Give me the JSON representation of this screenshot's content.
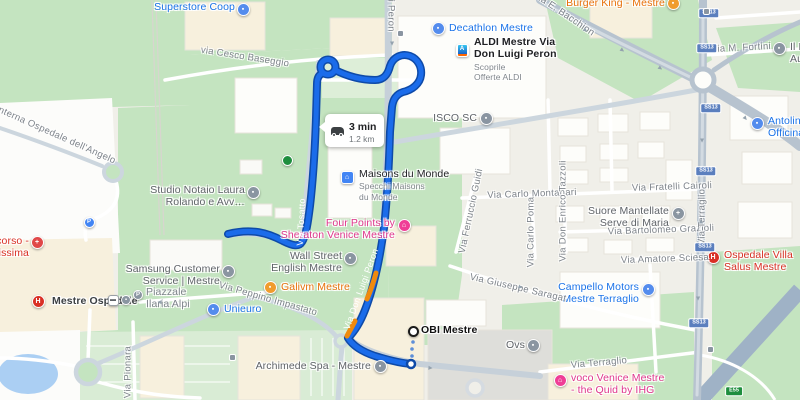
{
  "route_info": {
    "duration": "3 min",
    "distance": "1.2 km"
  },
  "colors": {
    "route": "#1b6cea",
    "route_casing": "#0e4aa8",
    "traffic": "#ef8a0e",
    "park_green": "#c4e4c0",
    "urban": "#f0efe9",
    "water": "#abcff3"
  },
  "pois": [
    {
      "id": "superstore-coop",
      "lines": [
        "Superstore Coop"
      ],
      "color": "#1a73e8",
      "align": "right",
      "rx": 235,
      "ly": 1,
      "icon": {
        "type": "circle",
        "bg": "#548ced",
        "glyph": "▪"
      },
      "ix": 243,
      "iy": 9
    },
    {
      "id": "burger-king",
      "lines": [
        "Burger King - Mestre"
      ],
      "color": "#e8710a",
      "align": "right",
      "rx": 665,
      "ly": -3,
      "icon": {
        "type": "circle",
        "bg": "#f09c2e",
        "glyph": "▪"
      },
      "ix": 673,
      "iy": 3
    },
    {
      "id": "decathlon",
      "lines": [
        "Decathlon Mestre"
      ],
      "color": "#1a73e8",
      "align": "left",
      "lx": 449,
      "ly": 22,
      "icon": {
        "type": "circle",
        "bg": "#548ced",
        "glyph": "▪"
      },
      "ix": 438,
      "iy": 28
    },
    {
      "id": "aldi",
      "lines": [
        "ALDI Mestre Via",
        "Don Luigi Peron"
      ],
      "bold": true,
      "color": "#202124",
      "sub": [
        "Scoprile",
        "Offerte ALDI"
      ],
      "align": "left",
      "lx": 474,
      "ly": 36,
      "icon": {
        "type": "aldi"
      },
      "ix": 462,
      "iy": 50
    },
    {
      "id": "isco-sc",
      "lines": [
        "ISCO SC"
      ],
      "color": "#5f6368",
      "align": "right",
      "rx": 477,
      "ly": 112,
      "icon": {
        "type": "circle",
        "bg": "#8a95a1",
        "glyph": "▪"
      },
      "ix": 486,
      "iy": 118
    },
    {
      "id": "il-f",
      "lines": [
        "Il F…",
        "Aut…"
      ],
      "color": "#5f6368",
      "align": "left",
      "lx": 790,
      "ly": 41,
      "icon": {
        "type": "circle",
        "bg": "#8a95a1",
        "glyph": "▪"
      },
      "ix": 779,
      "iy": 48
    },
    {
      "id": "antolini",
      "lines": [
        "Antolini Srl…",
        "Officina Au…"
      ],
      "color": "#1a73e8",
      "align": "left",
      "lx": 768,
      "ly": 115,
      "icon": {
        "type": "circle",
        "bg": "#548ced",
        "glyph": "▪"
      },
      "ix": 757,
      "iy": 123
    },
    {
      "id": "maisons-du-monde",
      "lines": [
        "Maisons du Monde"
      ],
      "color": "#202124",
      "sub": [
        "Specchi Maisons",
        "du Monde"
      ],
      "align": "left",
      "lx": 359,
      "ly": 168,
      "icon": {
        "type": "square",
        "bg": "#4285f4",
        "glyph": "⌂"
      },
      "ix": 347,
      "iy": 177
    },
    {
      "id": "four-points-sheraton",
      "lines": [
        "Four Points by",
        "Sheraton Venice Mestre"
      ],
      "color": "#e0368c",
      "align": "right",
      "rx": 395,
      "ly": 217,
      "icon": {
        "type": "circle",
        "bg": "#ef3e96",
        "glyph": "⌂"
      },
      "ix": 404,
      "iy": 225
    },
    {
      "id": "wall-street-english",
      "lines": [
        "Wall Street",
        "English Mestre"
      ],
      "color": "#5f6368",
      "align": "right",
      "rx": 342,
      "ly": 250,
      "icon": {
        "type": "circle",
        "bg": "#8a95a1",
        "glyph": "▪"
      },
      "ix": 350,
      "iy": 258
    },
    {
      "id": "studio-notaio",
      "lines": [
        "Studio Notaio Laura",
        "Rolando e Avv…"
      ],
      "color": "#5f6368",
      "align": "right",
      "rx": 245,
      "ly": 184,
      "icon": {
        "type": "circle",
        "bg": "#8a95a1",
        "glyph": "▪"
      },
      "ix": 253,
      "iy": 192
    },
    {
      "id": "pronto-soccorso",
      "lines": [
        "occorso -",
        "tenissima"
      ],
      "color": "#d93025",
      "align": "right",
      "rx": 29,
      "ly": 235,
      "icon": {
        "type": "circle",
        "bg": "#e04848",
        "glyph": "+"
      },
      "ix": 37,
      "iy": 242
    },
    {
      "id": "parking",
      "lines": [],
      "icon": {
        "type": "circle",
        "bg": "#4285f4",
        "glyph": "P",
        "size": 11
      },
      "ix": 89,
      "iy": 222
    },
    {
      "id": "samsung-service",
      "lines": [
        "Samsung Customer",
        "Service | Mestre"
      ],
      "color": "#5f6368",
      "align": "right",
      "rx": 220,
      "ly": 263,
      "icon": {
        "type": "circle",
        "bg": "#8a95a1",
        "glyph": "▪"
      },
      "ix": 228,
      "iy": 271
    },
    {
      "id": "galivm",
      "lines": [
        "Galivm Mestre"
      ],
      "color": "#e8710a",
      "align": "left",
      "lx": 281,
      "ly": 281,
      "icon": {
        "type": "circle",
        "bg": "#f09c2e",
        "glyph": "▪"
      },
      "ix": 270,
      "iy": 287
    },
    {
      "id": "unieuro",
      "lines": [
        "Unieuro"
      ],
      "color": "#1a73e8",
      "align": "left",
      "lx": 224,
      "ly": 303,
      "icon": {
        "type": "circle",
        "bg": "#548ced",
        "glyph": "▪"
      },
      "ix": 213,
      "iy": 309
    },
    {
      "id": "mestre-ospedale",
      "lines": [
        "Mestre Ospedale"
      ],
      "bold": true,
      "color": "#3c4043",
      "align": "left",
      "lx": 52,
      "ly": 295,
      "icon": {
        "type": "circle",
        "bg": "#d93025",
        "glyph": "H"
      },
      "ix": 38,
      "iy": 301
    },
    {
      "id": "tram-stop",
      "lines": [],
      "icon": {
        "type": "roundsq",
        "glyph": "▬",
        "size": 11
      },
      "ix": 113,
      "iy": 300
    },
    {
      "id": "station-secondary",
      "lines": [],
      "icon": {
        "type": "circle",
        "bg": "#8a95a1",
        "glyph": "▪",
        "size": 10
      },
      "ix": 126,
      "iy": 300
    },
    {
      "id": "station-parking",
      "lines": [],
      "icon": {
        "type": "circle",
        "bg": "#8a95a1",
        "glyph": "P",
        "size": 10
      },
      "ix": 138,
      "iy": 295
    },
    {
      "id": "piazzale-ilaria-alpi",
      "lines": [
        "Piazzale",
        "Ilaria Alpi"
      ],
      "color": "#7d838a",
      "align": "left",
      "lx": 146,
      "ly": 286
    },
    {
      "id": "obi-mestre",
      "lines": [
        "OBI Mestre"
      ],
      "bold": true,
      "color": "#111111",
      "align": "left",
      "lx": 421,
      "ly": 324,
      "icon": {
        "type": "obi",
        "size": 11
      },
      "ix": 413,
      "iy": 331
    },
    {
      "id": "archimede-spa",
      "lines": [
        "Archimede Spa - Mestre"
      ],
      "color": "#5f6368",
      "align": "right",
      "rx": 371,
      "ly": 360,
      "icon": {
        "type": "circle",
        "bg": "#8a95a1",
        "glyph": "▪"
      },
      "ix": 380,
      "iy": 366
    },
    {
      "id": "ovs",
      "lines": [
        "Ovs"
      ],
      "color": "#5f6368",
      "align": "right",
      "rx": 525,
      "ly": 339,
      "icon": {
        "type": "circle",
        "bg": "#8a95a1",
        "glyph": "▪"
      },
      "ix": 533,
      "iy": 345
    },
    {
      "id": "campello-motors",
      "lines": [
        "Campello Motors",
        "Mestre Terraglio"
      ],
      "color": "#1a73e8",
      "align": "right",
      "rx": 639,
      "ly": 281,
      "icon": {
        "type": "circle",
        "bg": "#548ced",
        "glyph": "▪"
      },
      "ix": 648,
      "iy": 289
    },
    {
      "id": "voco-venice",
      "lines": [
        "voco Venice Mestre",
        "- the Quid by IHG"
      ],
      "color": "#e0368c",
      "align": "left",
      "lx": 571,
      "ly": 372,
      "icon": {
        "type": "circle",
        "bg": "#ef3e96",
        "glyph": "⌂"
      },
      "ix": 560,
      "iy": 380
    },
    {
      "id": "ospedale-villa-salus",
      "lines": [
        "Ospedale Villa",
        "Salus Mestre"
      ],
      "color": "#d93025",
      "align": "left",
      "lx": 724,
      "ly": 249,
      "icon": {
        "type": "circle",
        "bg": "#d93025",
        "glyph": "H"
      },
      "ix": 713,
      "iy": 257
    },
    {
      "id": "suore-mantellate",
      "lines": [
        "Suore Mantellate",
        "Serve di Maria"
      ],
      "color": "#5f6368",
      "align": "right",
      "rx": 669,
      "ly": 205,
      "icon": {
        "type": "circle",
        "bg": "#8a95a1",
        "glyph": "+"
      },
      "ix": 678,
      "iy": 213
    },
    {
      "id": "park-poi",
      "lines": [],
      "icon": {
        "type": "circle",
        "bg": "#1e8e3e",
        "glyph": "",
        "size": 11
      },
      "ix": 287,
      "iy": 160
    }
  ],
  "street_labels": [
    {
      "text": "via Cesco Baseggio",
      "x": 245,
      "y": 57,
      "rot": 9
    },
    {
      "text": "Viabilità Interna Ospedale dell'Angelo",
      "x": 38,
      "y": 127,
      "rot": 24
    },
    {
      "text": "gi Peron",
      "x": 391,
      "y": 13,
      "rot": 90
    },
    {
      "text": "Via E. Bacchion",
      "x": 564,
      "y": 14,
      "rot": 34
    },
    {
      "text": "Via M. Fortini",
      "x": 741,
      "y": 48,
      "rot": -3
    },
    {
      "text": "Via Fratelli Cairoli",
      "x": 672,
      "y": 187,
      "rot": -2
    },
    {
      "text": "Via Carlo Montanari",
      "x": 532,
      "y": 194,
      "rot": -2
    },
    {
      "text": "Via Don Enrico Tazzoli",
      "x": 563,
      "y": 211,
      "rot": -90
    },
    {
      "text": "Via Carlo Poma",
      "x": 531,
      "y": 232,
      "rot": -90
    },
    {
      "text": "Via Ferruccio Guidi",
      "x": 471,
      "y": 211,
      "rot": -78
    },
    {
      "text": "Via Bartolomeo Grazioli",
      "x": 661,
      "y": 230,
      "rot": -2
    },
    {
      "text": "Via Amatore Sciesa",
      "x": 665,
      "y": 259,
      "rot": -2
    },
    {
      "text": "Via Terraglio",
      "x": 702,
      "y": 217,
      "rot": -90
    },
    {
      "text": "Via Terraglio",
      "x": 599,
      "y": 363,
      "rot": -5
    },
    {
      "text": "Via Giuseppe Saragat",
      "x": 518,
      "y": 288,
      "rot": 13
    },
    {
      "text": "Via Peppino Impastato",
      "x": 268,
      "y": 299,
      "rot": 16
    },
    {
      "text": "Via Pionara",
      "x": 128,
      "y": 372,
      "rot": -90
    },
    {
      "text": "Via Don Luigi Peron",
      "x": 361,
      "y": 289,
      "rot": -70,
      "white": true
    },
    {
      "text": "Via Tosatto",
      "x": 301,
      "y": 222,
      "rot": -87,
      "white": true
    }
  ],
  "shields": [
    {
      "t": "SS13",
      "x": 709,
      "y": 13
    },
    {
      "t": "SS13",
      "x": 707,
      "y": 48
    },
    {
      "t": "SS13",
      "x": 711,
      "y": 108
    },
    {
      "t": "SS13",
      "x": 706,
      "y": 171
    },
    {
      "t": "SS13",
      "x": 705,
      "y": 247
    },
    {
      "t": "SS13",
      "x": 699,
      "y": 323
    },
    {
      "t": "E55",
      "x": 734,
      "y": 391,
      "green": true
    }
  ],
  "road_arrows": [
    {
      "x": 622,
      "y": 50,
      "r": 125
    },
    {
      "x": 660,
      "y": 68,
      "r": 125
    },
    {
      "x": 585,
      "y": 30,
      "r": 125
    },
    {
      "x": 745,
      "y": 118,
      "r": 140
    },
    {
      "x": 702,
      "y": 140,
      "r": 180
    },
    {
      "x": 701,
      "y": 222,
      "r": 0
    },
    {
      "x": 698,
      "y": 298,
      "r": 180
    },
    {
      "x": 520,
      "y": 287,
      "r": 110
    },
    {
      "x": 430,
      "y": 368,
      "r": 95
    },
    {
      "x": 160,
      "y": 302,
      "r": -85
    },
    {
      "x": 392,
      "y": 43,
      "r": 180
    }
  ],
  "road_icons": [
    {
      "x": 400,
      "y": 33
    },
    {
      "x": 710,
      "y": 349
    },
    {
      "x": 232,
      "y": 357
    },
    {
      "x": 706,
      "y": 11
    }
  ]
}
